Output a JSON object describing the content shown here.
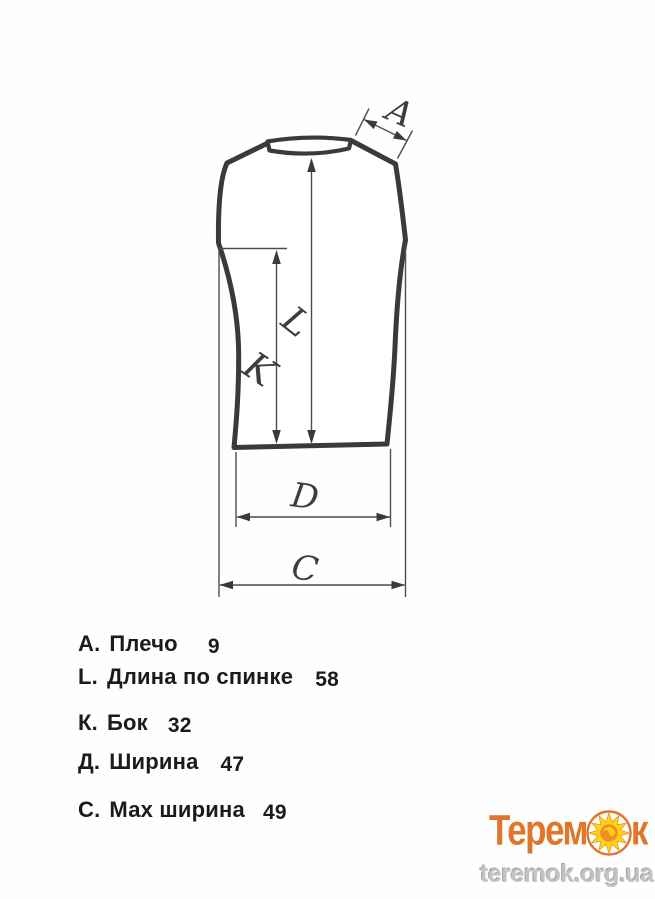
{
  "diagram": {
    "type": "garment-measurement-drawing",
    "garment": "sleeveless vest / tank top, back view",
    "line_color": "#3a3a3a",
    "dimension_letters": {
      "shoulder": "A",
      "back_length": "L",
      "side": "K",
      "width": "D",
      "max_width": "C"
    }
  },
  "measurements": {
    "items": [
      {
        "letter": "А.",
        "name": "Плечо",
        "value": "9"
      },
      {
        "letter": "L.",
        "name": "Длина по спинке",
        "value": "58"
      },
      {
        "letter": "К.",
        "name": "Бок",
        "value": "32"
      },
      {
        "letter": "Д.",
        "name": "Ширина",
        "value": "47"
      },
      {
        "letter": "С.",
        "name": "Мах ширина",
        "value": "49"
      }
    ]
  },
  "branding": {
    "logo_text_part1": "Терем",
    "logo_text_part2": "к",
    "sun_icon": "sun-icon",
    "website": "teremok.org.ua",
    "logo_color": "#e0762c",
    "sun_yellow": "#ffd417"
  }
}
